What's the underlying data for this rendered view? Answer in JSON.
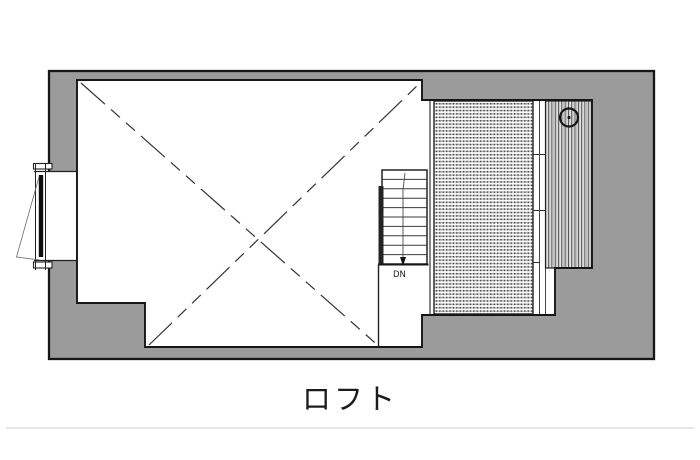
{
  "caption": {
    "label": "ロフト"
  },
  "plan": {
    "stair_label": "DN",
    "colors": {
      "wall_fill": "#9b9b9b",
      "wall_edge": "#161616",
      "line_dark": "#222222",
      "floor_white": "#ffffff",
      "swing_line": "#6a6a6a",
      "caption_text": "#1c1c1c",
      "page_divider": "#e8e8e8"
    }
  }
}
